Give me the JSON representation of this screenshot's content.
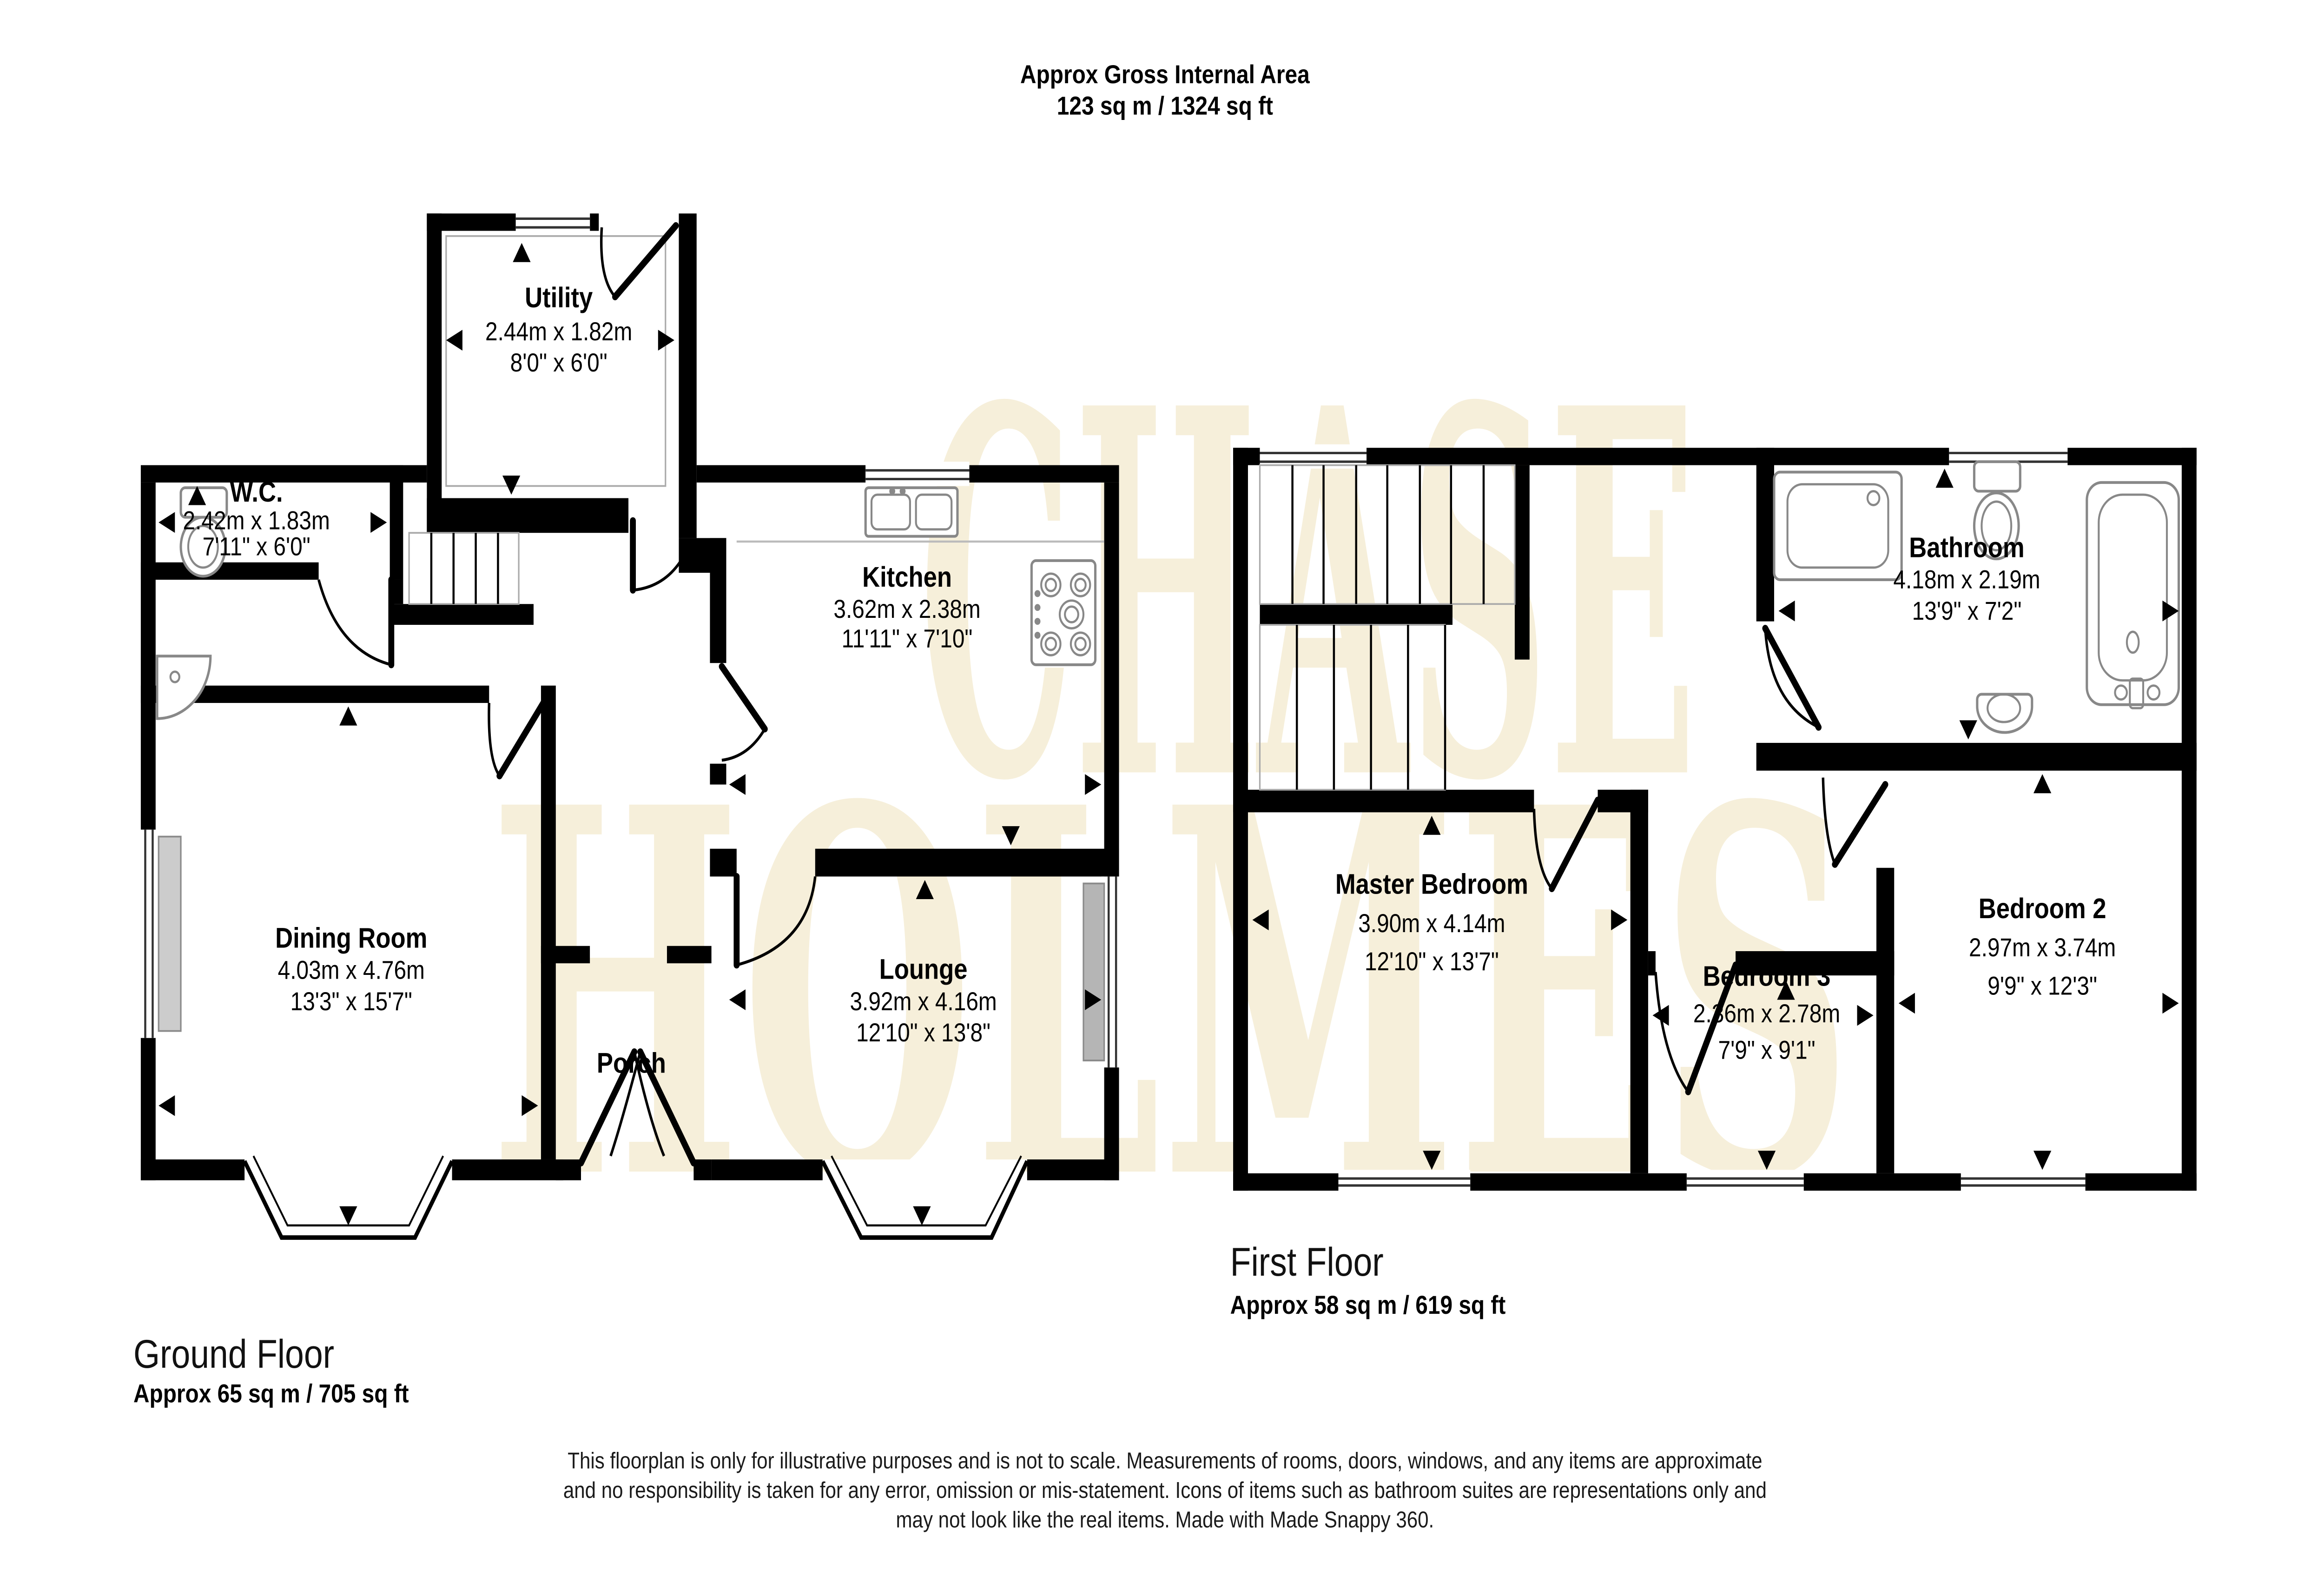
{
  "title": {
    "line1": "Approx Gross Internal Area",
    "line2": "123 sq m / 1324 sq ft"
  },
  "watermark": {
    "line1": "CHASE",
    "line2": "HOLMES"
  },
  "ground_floor": {
    "label": "Ground Floor",
    "area": "Approx 65 sq m / 705 sq ft",
    "rooms": {
      "utility": {
        "name": "Utility",
        "metric": "2.44m x 1.82m",
        "imperial": "8'0\" x 6'0\""
      },
      "wc": {
        "name": "W.C.",
        "metric": "2.42m x 1.83m",
        "imperial": "7'11\" x 6'0\""
      },
      "kitchen": {
        "name": "Kitchen",
        "metric": "3.62m x 2.38m",
        "imperial": "11'11\" x 7'10\""
      },
      "dining": {
        "name": "Dining Room",
        "metric": "4.03m x 4.76m",
        "imperial": "13'3\" x 15'7\""
      },
      "lounge": {
        "name": "Lounge",
        "metric": "3.92m x 4.16m",
        "imperial": "12'10\" x 13'8\""
      },
      "porch": {
        "name": "Porch"
      }
    }
  },
  "first_floor": {
    "label": "First Floor",
    "area": "Approx 58 sq m / 619 sq ft",
    "rooms": {
      "master": {
        "name": "Master Bedroom",
        "metric": "3.90m x 4.14m",
        "imperial": "12'10\" x 13'7\""
      },
      "bathroom": {
        "name": "Bathroom",
        "metric": "4.18m x 2.19m",
        "imperial": "13'9\" x 7'2\""
      },
      "bedroom3": {
        "name": "Bedroom 3",
        "metric": "2.36m x 2.78m",
        "imperial": "7'9\" x 9'1\""
      },
      "bedroom2": {
        "name": "Bedroom 2",
        "metric": "2.97m x 3.74m",
        "imperial": "9'9\" x 12'3\""
      }
    }
  },
  "disclaimer": {
    "line1": "This floorplan is only for illustrative purposes and is not to scale. Measurements of rooms, doors, windows, and any items are approximate",
    "line2": "and no responsibility is taken for any error, omission or mis-statement. Icons of items such as bathroom suites are representations only and",
    "line3": "may not look like the real items. Made with Made Snappy 360."
  }
}
